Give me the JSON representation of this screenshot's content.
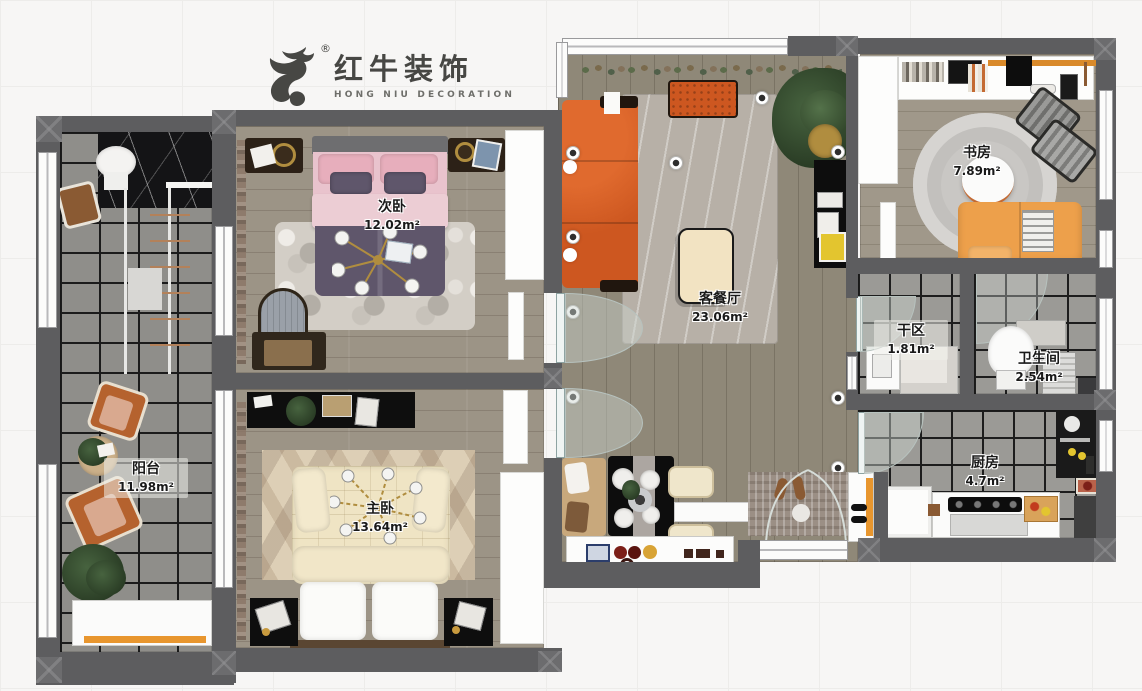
{
  "brand": {
    "cn": "红牛装饰",
    "en": "HONG NIU DECORATION",
    "mark": "®"
  },
  "rooms": [
    {
      "id": "balcony",
      "name": "阳台",
      "area": "11.98m²"
    },
    {
      "id": "secondary-bedroom",
      "name": "次卧",
      "area": "12.02m²"
    },
    {
      "id": "master-bedroom",
      "name": "主卧",
      "area": "13.64m²"
    },
    {
      "id": "living-dining",
      "name": "客餐厅",
      "area": "23.06m²"
    },
    {
      "id": "study",
      "name": "书房",
      "area": "7.89m²"
    },
    {
      "id": "dry-area",
      "name": "干区",
      "area": "1.81m²"
    },
    {
      "id": "bathroom",
      "name": "卫生间",
      "area": "2.54m²"
    },
    {
      "id": "kitchen",
      "name": "厨房",
      "area": "4.7m²"
    }
  ],
  "colors": {
    "wall": "#5d5d5f",
    "accent_orange": "#d25a20",
    "sofa_light_orange": "#eda04b",
    "wood_floor": "#948b7c",
    "tile_floor": "#8f8e8a",
    "bed_pink": "#e9c3cd",
    "bed_purple": "#5f566b",
    "bed_cream": "#efe4c4",
    "logo_gray": "#4a4a47"
  }
}
